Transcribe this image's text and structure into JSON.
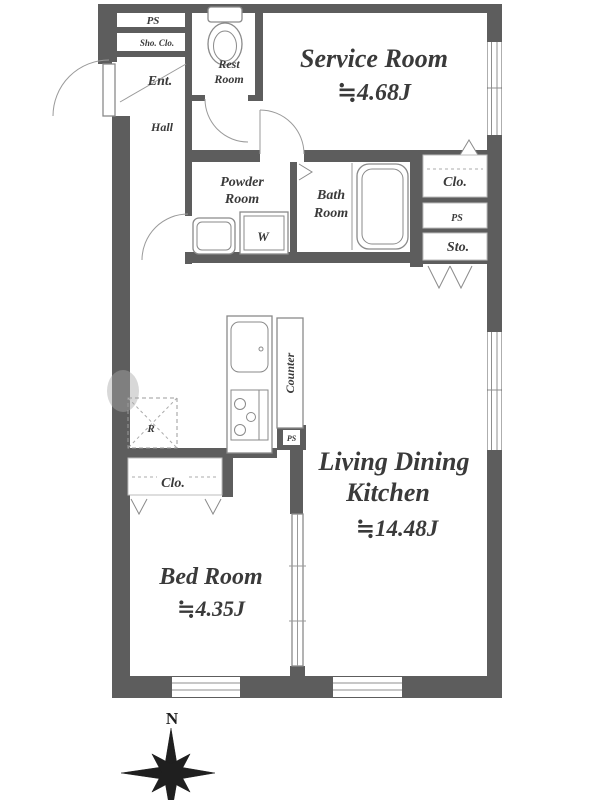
{
  "floor_plan": {
    "compass_label": "N",
    "rooms": {
      "ps_top": "PS",
      "shoe_closet": "Sho. Clo.",
      "entrance": "Ent.",
      "hall": "Hall",
      "rest_room_line1": "Rest",
      "rest_room_line2": "Room",
      "service_room_name": "Service Room",
      "service_room_size": "≒4.68J",
      "powder_room_line1": "Powder",
      "powder_room_line2": "Room",
      "washer_label": "W",
      "bath_room_line1": "Bath",
      "bath_room_line2": "Room",
      "closet_mid": "Clo.",
      "ps_mid": "PS",
      "storage": "Sto.",
      "counter": "Counter",
      "ps_kitchen": "PS",
      "refrigerator": "R",
      "closet_bedroom": "Clo.",
      "bed_room_name": "Bed Room",
      "bed_room_size": "≒4.35J",
      "ldk_line1": "Living Dining",
      "ldk_line2": "Kitchen",
      "ldk_size": "≒14.48J"
    },
    "colors": {
      "wall": "#5d5d5d",
      "fixture_line": "#8a8a8a",
      "text": "#3a3a3a",
      "compass": "#1f1f1f",
      "background": "#ffffff"
    }
  }
}
